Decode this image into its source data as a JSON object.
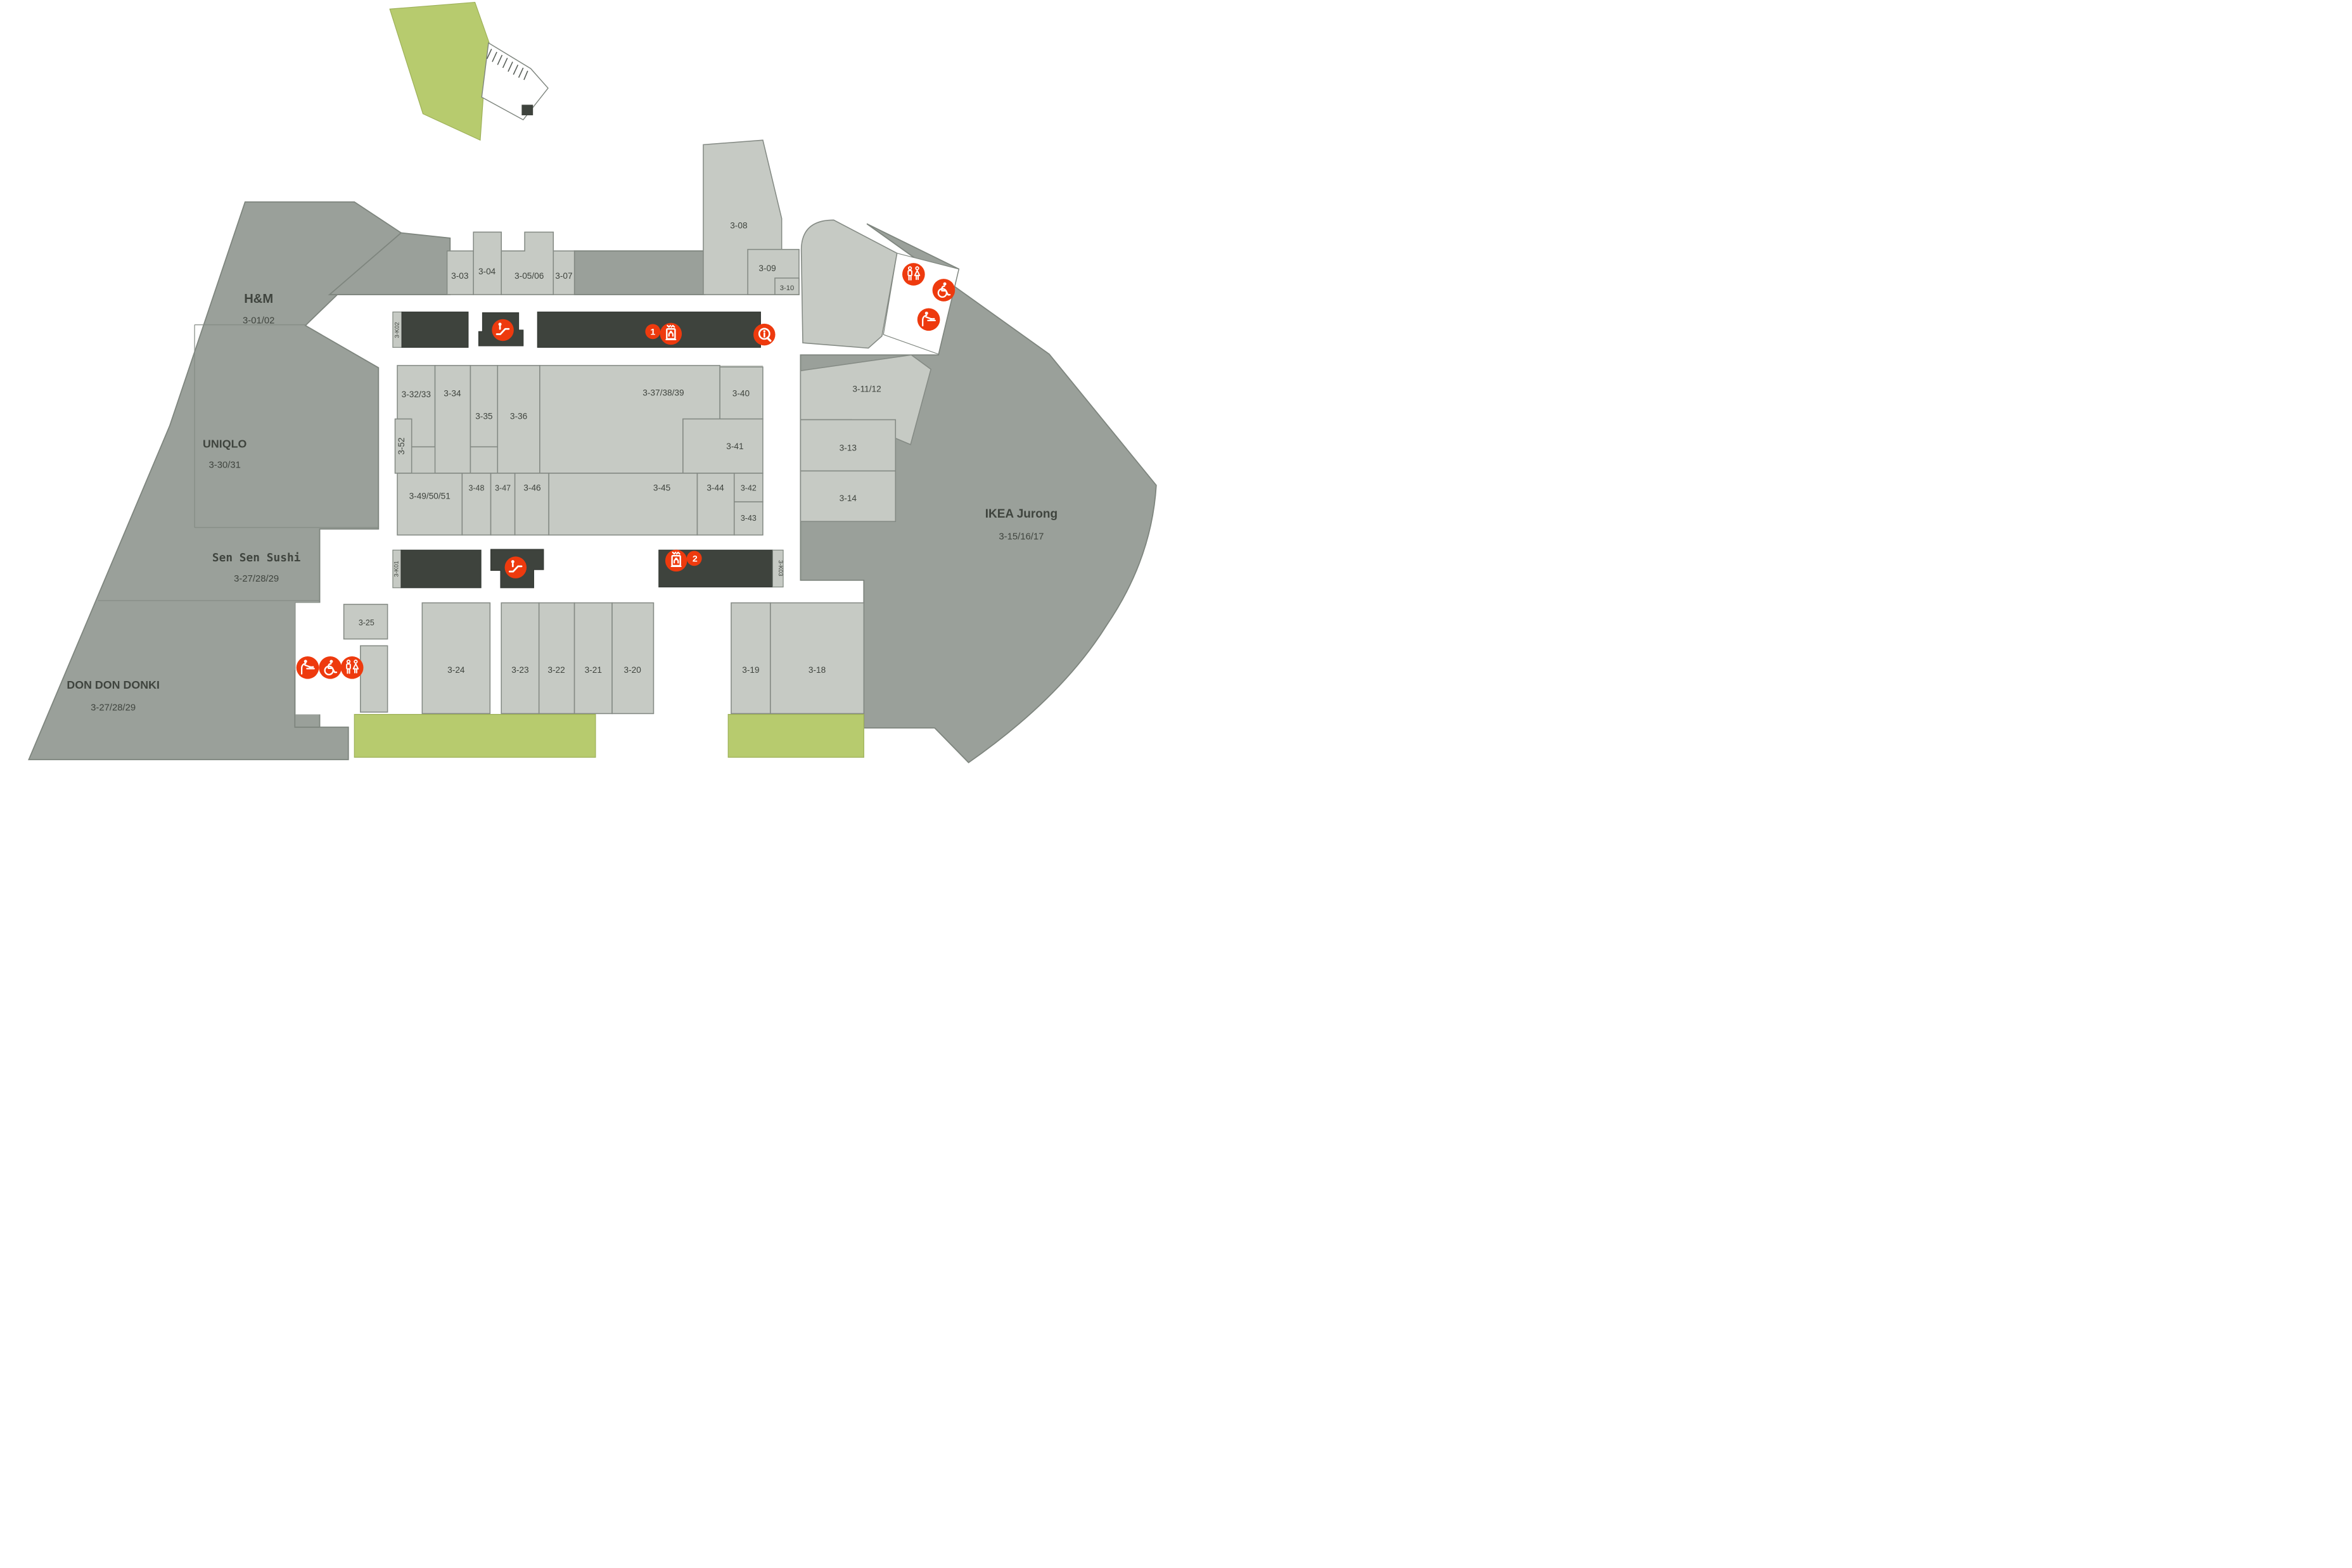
{
  "stores": {
    "hm": {
      "name": "H&M",
      "unit": "3-01/02"
    },
    "uniqlo": {
      "name": "UNIQLO",
      "unit": "3-30/31"
    },
    "sensen": {
      "name": "Sen Sen Sushi",
      "unit": "3-27/28/29"
    },
    "donki": {
      "name": "DON DON DONKI",
      "unit": "3-27/28/29"
    },
    "ikea": {
      "name": "IKEA Jurong",
      "unit": "3-15/16/17"
    }
  },
  "units": {
    "u03": "3-03",
    "u04": "3-04",
    "u0506": "3-05/06",
    "u07": "3-07",
    "u08": "3-08",
    "u09": "3-09",
    "u10": "3-10",
    "u1112": "3-11/12",
    "u13": "3-13",
    "u14": "3-14",
    "u18": "3-18",
    "u19": "3-19",
    "u20": "3-20",
    "u21": "3-21",
    "u22": "3-22",
    "u23": "3-23",
    "u24": "3-24",
    "u25": "3-25",
    "u3233": "3-32/33",
    "u34": "3-34",
    "u35": "3-35",
    "u36": "3-36",
    "u373839": "3-37/38/39",
    "u40": "3-40",
    "u41": "3-41",
    "u42": "3-42",
    "u43": "3-43",
    "u44": "3-44",
    "u45": "3-45",
    "u46": "3-46",
    "u47": "3-47",
    "u48": "3-48",
    "u495051": "3-49/50/51",
    "u52": "3-52"
  },
  "kiosks": {
    "k01": "3-K01",
    "k02": "3-K02",
    "k03": "3-K03"
  },
  "lifts": {
    "lift1_badge": "1",
    "lift2_badge": "2"
  },
  "icons": {
    "escalator": "escalator",
    "lift": "lift",
    "information": "information",
    "toilets": "toilets",
    "accessible_toilet": "accessible-toilet",
    "baby_change": "baby-change"
  },
  "colors": {
    "accent_red": "#EE3A0E",
    "mass_gray": "#9AA09A",
    "unit_gray": "#C6CAC4",
    "kiosk_dark": "#3E433D",
    "landscape_green": "#B7CB6E",
    "label": "#3F443E"
  }
}
